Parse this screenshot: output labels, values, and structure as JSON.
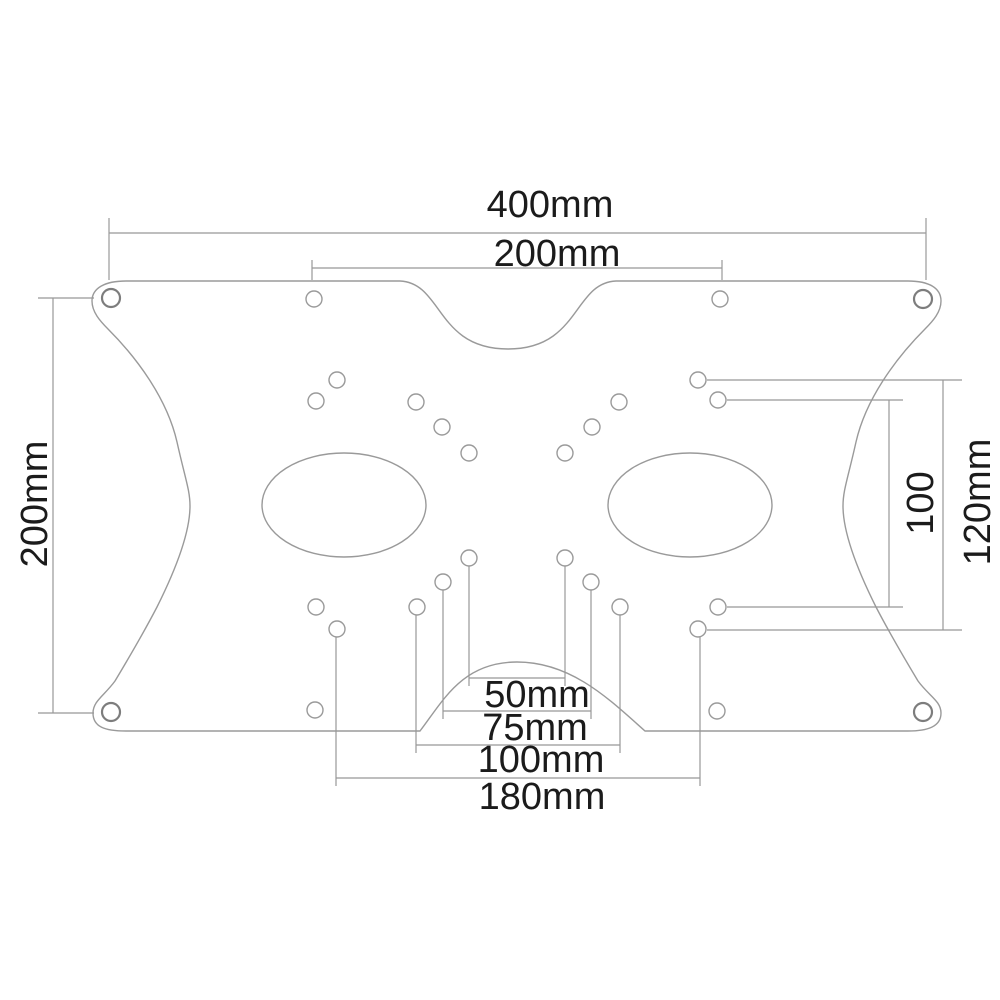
{
  "diagram": {
    "background_color": "#ffffff",
    "line_color": "#9a9a9a",
    "text_color": "#1b1b1b",
    "dims": {
      "d400": {
        "label": "400mm",
        "side": "top"
      },
      "d200_top": {
        "label": "200mm",
        "side": "top"
      },
      "d200_left": {
        "label": "200mm",
        "side": "left"
      },
      "d100_right": {
        "label": "100",
        "side": "right"
      },
      "d120_right": {
        "label": "120mm",
        "side": "right"
      },
      "d50_bottom": {
        "label": "50mm",
        "side": "bottom"
      },
      "d75_bottom": {
        "label": "75mm",
        "side": "bottom"
      },
      "d100_bottom": {
        "label": "100mm",
        "side": "bottom"
      },
      "d180_bottom": {
        "label": "180mm",
        "side": "bottom"
      }
    }
  }
}
